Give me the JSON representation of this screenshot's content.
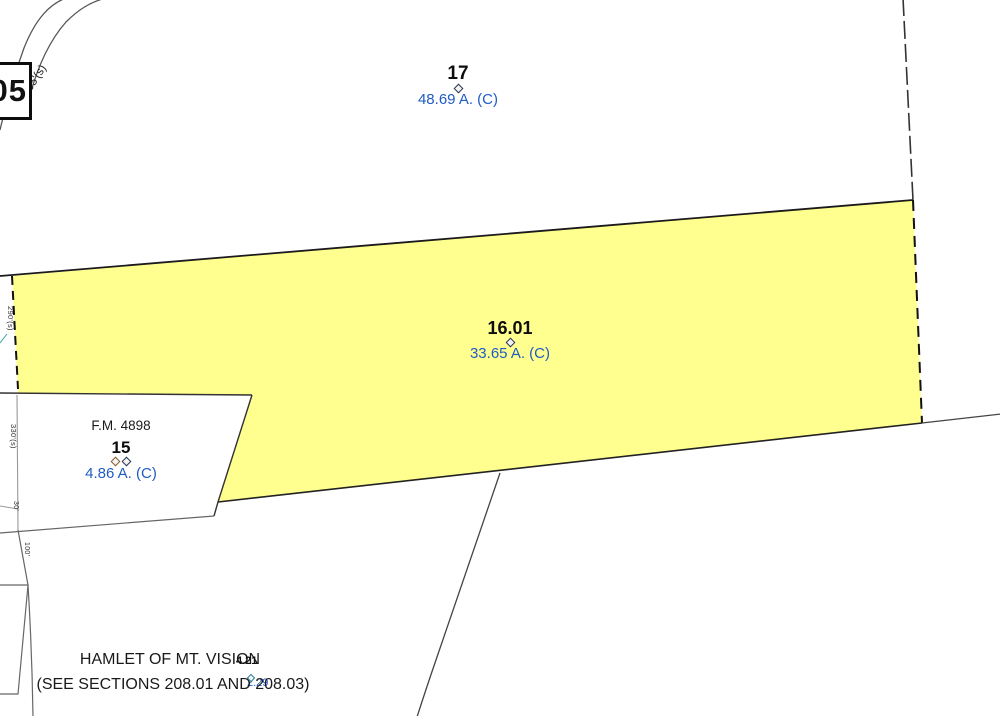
{
  "map": {
    "route_box_label": "05",
    "road_distance_label": "1105'(s)",
    "parcels": {
      "p17": {
        "number": "17",
        "acreage": "48.69 A. (C)"
      },
      "p16_01": {
        "number": "16.01",
        "acreage": "33.65 A. (C)",
        "highlighted": "yes"
      },
      "p15": {
        "number": "15",
        "acreage": "4.86 A. (C)",
        "fm_reference": "F.M. 4898"
      },
      "p4_21": {
        "number": "4.21",
        "acreage_partial": "2.29"
      }
    },
    "dimensions": {
      "left_upper": "290'(s)",
      "left_mid": "330'(s)",
      "left_small": "30'",
      "left_lower": "100'"
    },
    "hamlet_note": {
      "line1": "HAMLET OF MT. VISION",
      "line2": "(SEE SECTIONS 208.01 AND 208.03)"
    },
    "colors": {
      "parcel_highlight": "#FFFF8F",
      "acreage_text": "#1F5BC4",
      "boundary": "#333333"
    }
  }
}
